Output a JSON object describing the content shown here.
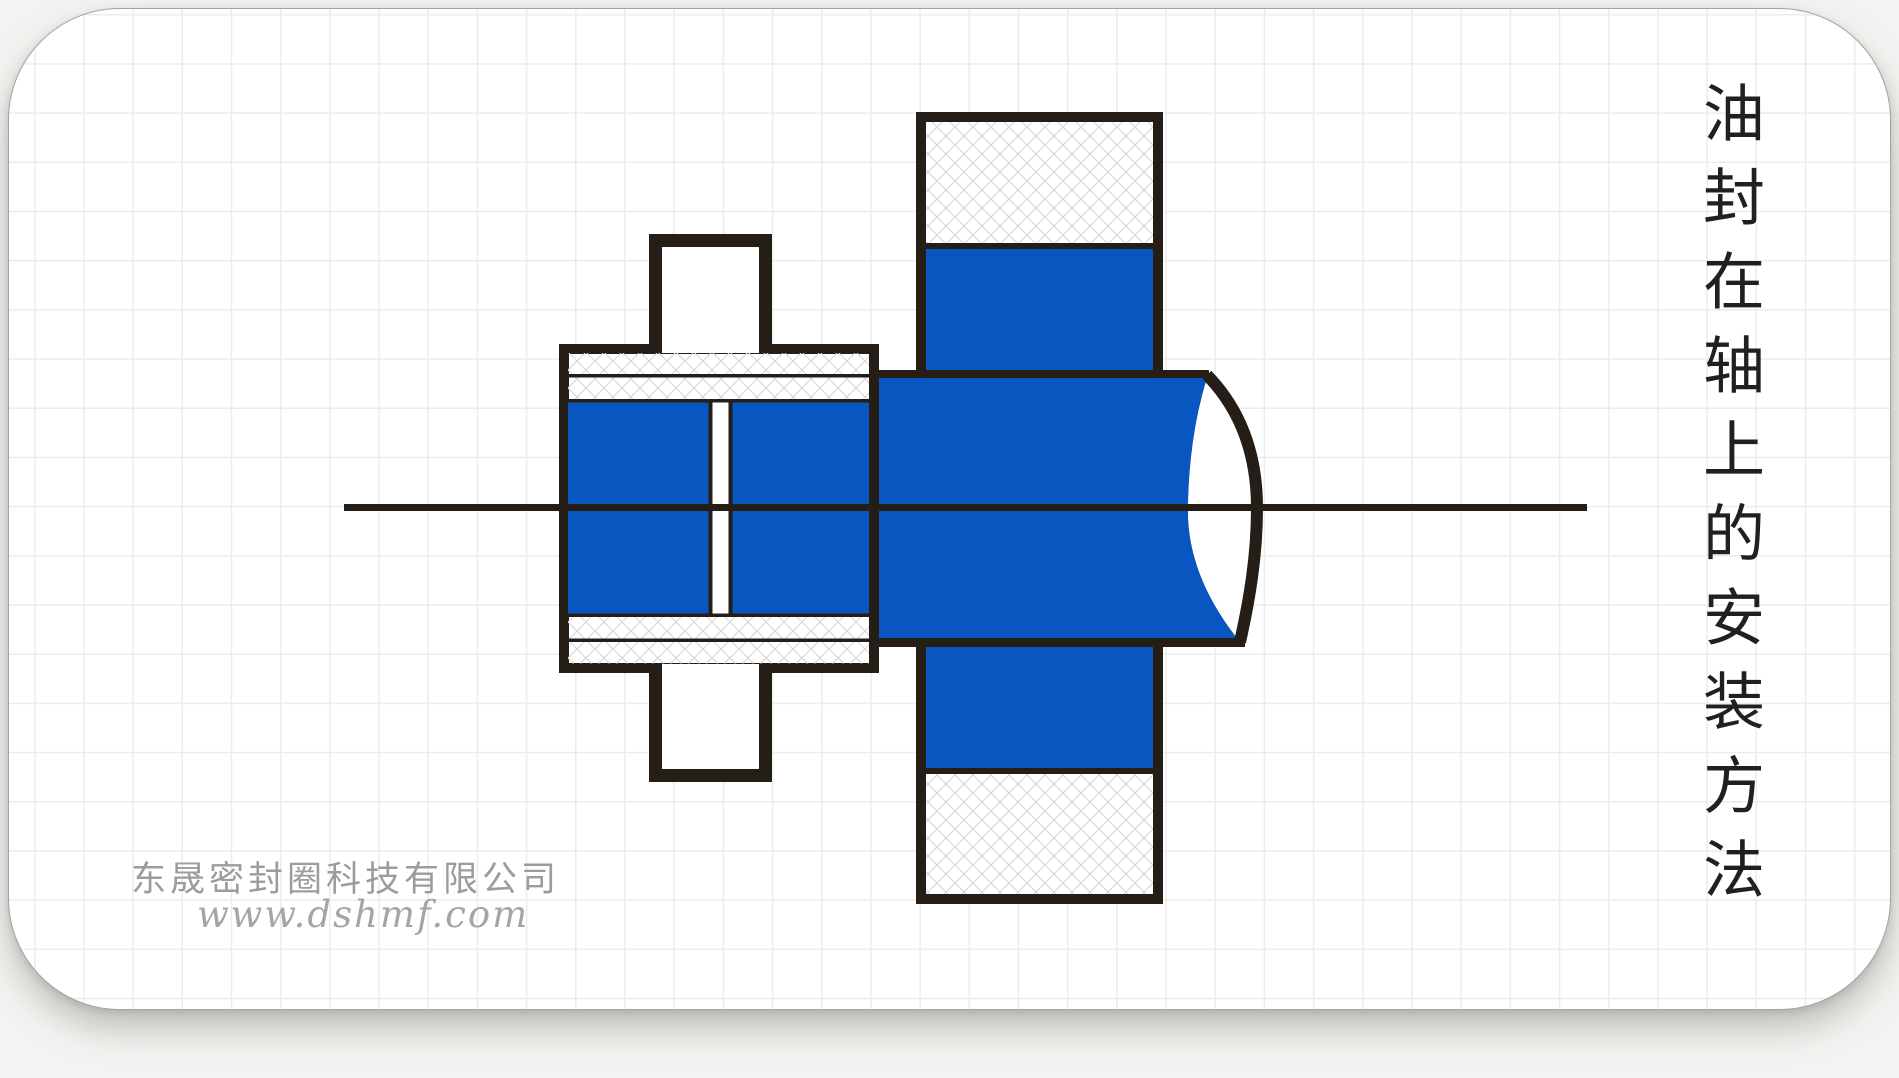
{
  "colors": {
    "page": "#f4f3f1",
    "card": "#ffffff",
    "grid": "#ececec",
    "line": "#241e17",
    "blue": "#0a56c0",
    "hatch": "#d6d6d6",
    "title": "#202020",
    "watermark": "#9c9c9c",
    "watermark2": "#a5a5a5"
  },
  "title": {
    "text": "油封在轴上的安装方法",
    "orientation": "vertical"
  },
  "watermark": {
    "company": "东晟密封圈科技有限公司",
    "website": "www.dshmf.com"
  },
  "diagram": {
    "parts": {
      "seal": "oil-seal-cross-section",
      "shaft": "shaft-cross-section",
      "housing": "housing-bore-cross-section",
      "centerline": "shaft-axis-centerline"
    }
  }
}
